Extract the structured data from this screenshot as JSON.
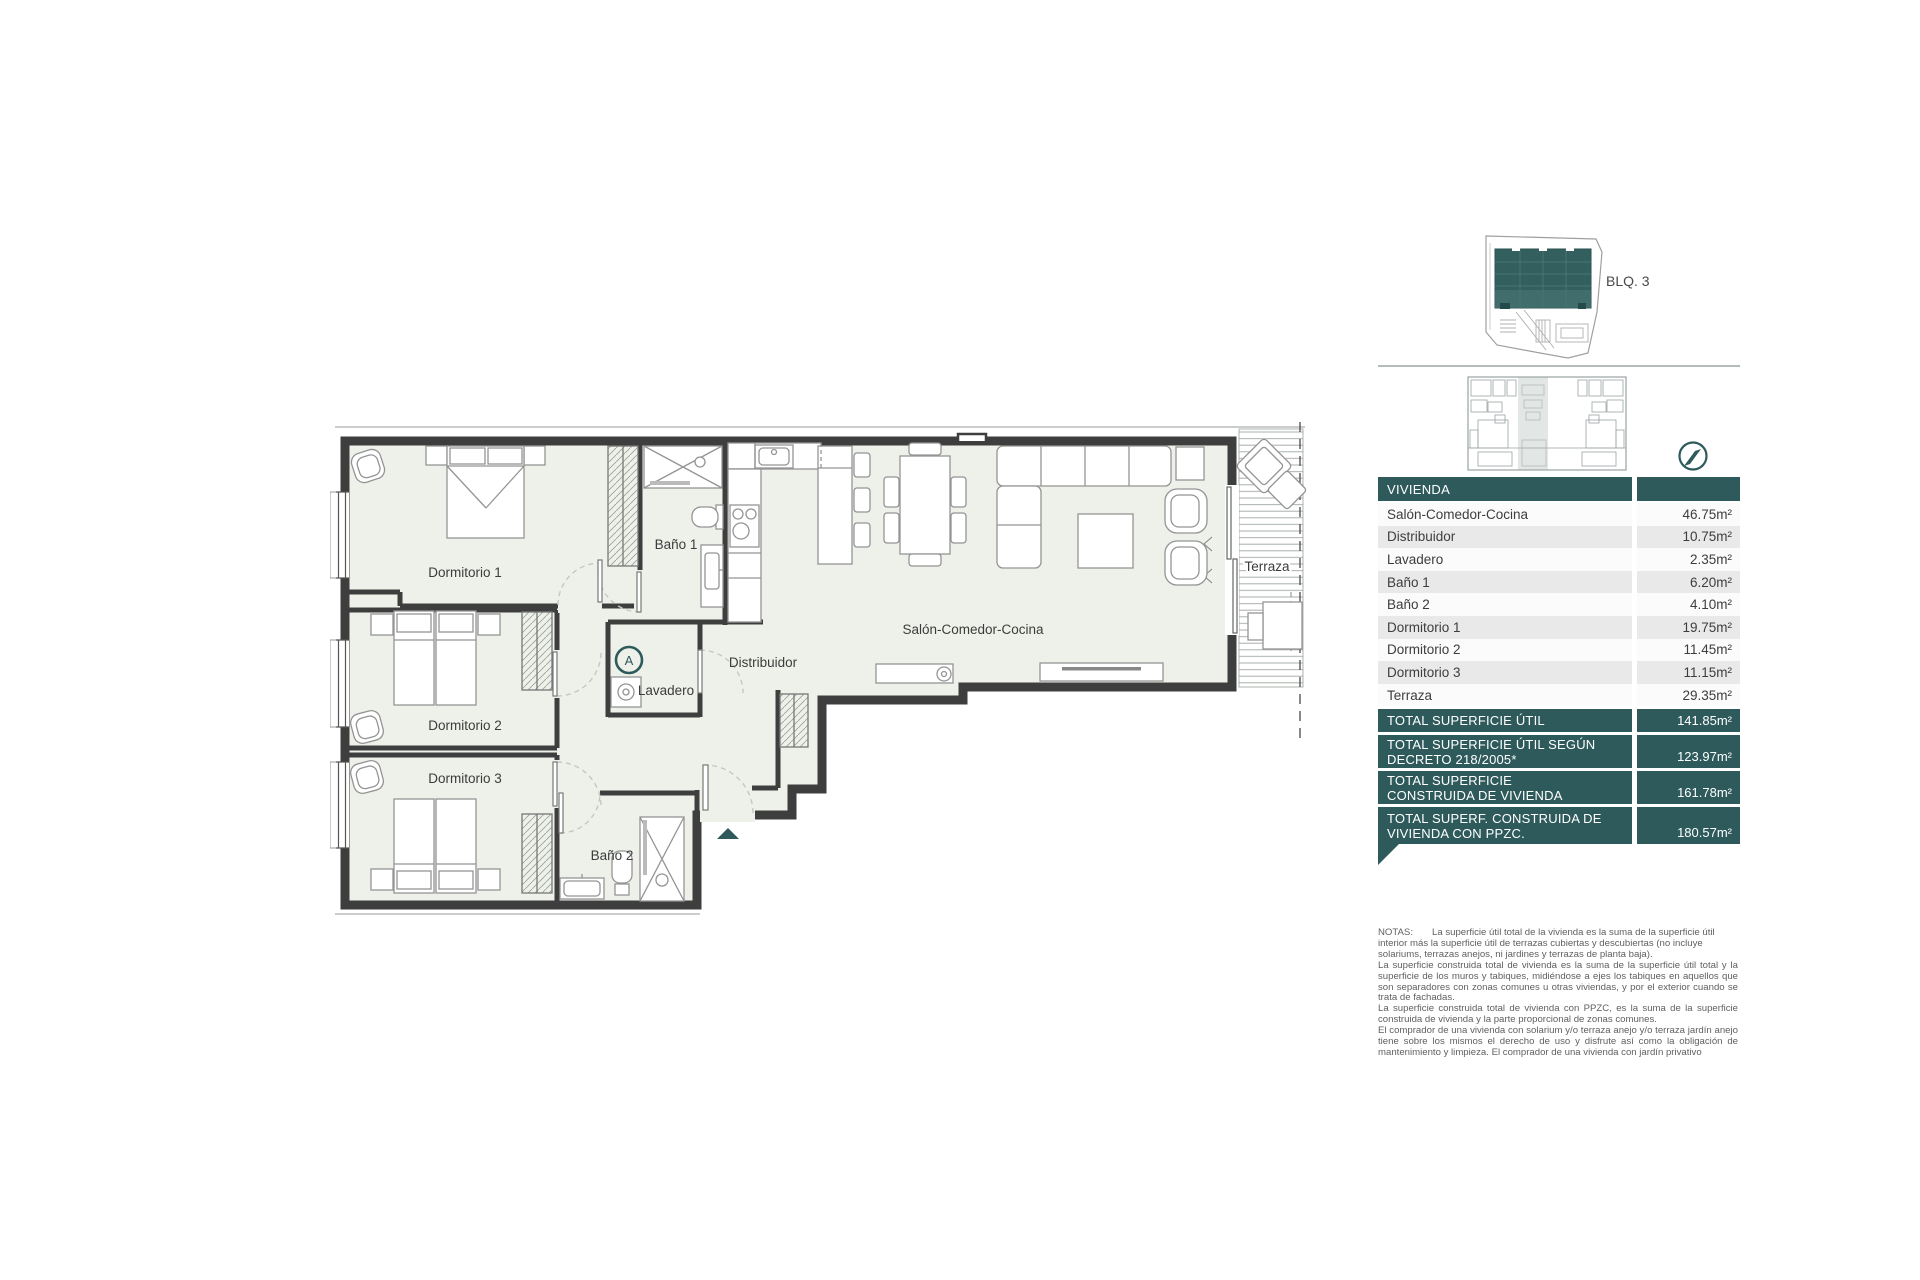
{
  "plan": {
    "rooms": {
      "dormitorio_1": "Dormitorio 1",
      "dormitorio_2": "Dormitorio 2",
      "dormitorio_3": "Dormitorio 3",
      "bano_1": "Baño 1",
      "bano_2": "Baño 2",
      "lavadero": "Lavadero",
      "distribuidor": "Distribuidor",
      "salon": "Salón-Comedor-Cocina",
      "terraza": "Terraza"
    },
    "unit_marker": "A"
  },
  "sidebar": {
    "block_label": "BLQ. 3",
    "accent_color": "#2e5a5b",
    "table": {
      "header": "VIVIENDA",
      "rows": [
        {
          "label": "Salón-Comedor-Cocina",
          "value": "46.75m²"
        },
        {
          "label": "Distribuidor",
          "value": "10.75m²"
        },
        {
          "label": "Lavadero",
          "value": "2.35m²"
        },
        {
          "label": "Baño 1",
          "value": "6.20m²"
        },
        {
          "label": "Baño 2",
          "value": "4.10m²"
        },
        {
          "label": "Dormitorio 1",
          "value": "19.75m²"
        },
        {
          "label": "Dormitorio 2",
          "value": "11.45m²"
        },
        {
          "label": "Dormitorio 3",
          "value": "11.15m²"
        },
        {
          "label": "Terraza",
          "value": "29.35m²"
        }
      ],
      "totals": [
        {
          "line1": "TOTAL SUPERFICIE ÚTIL",
          "line2": "",
          "value": "141.85m²"
        },
        {
          "line1": "TOTAL SUPERFICIE ÚTIL SEGÚN",
          "line2": "DECRETO 218/2005*",
          "value": "123.97m²"
        },
        {
          "line1": "TOTAL SUPERFICIE",
          "line2": "CONSTRUIDA DE VIVIENDA",
          "value": "161.78m²"
        },
        {
          "line1": "TOTAL SUPERF. CONSTRUIDA DE",
          "line2": "VIVIENDA CON PPZC.",
          "value": "180.57m²"
        }
      ]
    },
    "notes": {
      "label": "NOTAS:",
      "p1": "La superficie útil total de la vivienda es la suma de la superficie útil interior más la superficie útil de terrazas cubiertas y descubiertas (no incluye solariums, terrazas anejos, ni jardines y terrazas de planta baja).",
      "p2": "La superficie construida total de vivienda es la suma de la superficie útil total y la superficie de los muros y tabiques, midiéndose a ejes los tabiques en aquellos que son separadores con zonas comunes u otras viviendas, y por el exterior cuando se trata de fachadas.",
      "p3": "La superficie construida total de vivienda con PPZC, es la suma de la superficie construida de vivienda y la parte proporcional de zonas comunes.",
      "p4": "El comprador de una vivienda con solarium y/o terraza anejo y/o terraza jardín anejo tiene sobre los mismos el derecho de uso y disfrute así como la obligación de mantenimiento y limpieza. El comprador de una vivienda con jardín privativo"
    }
  }
}
